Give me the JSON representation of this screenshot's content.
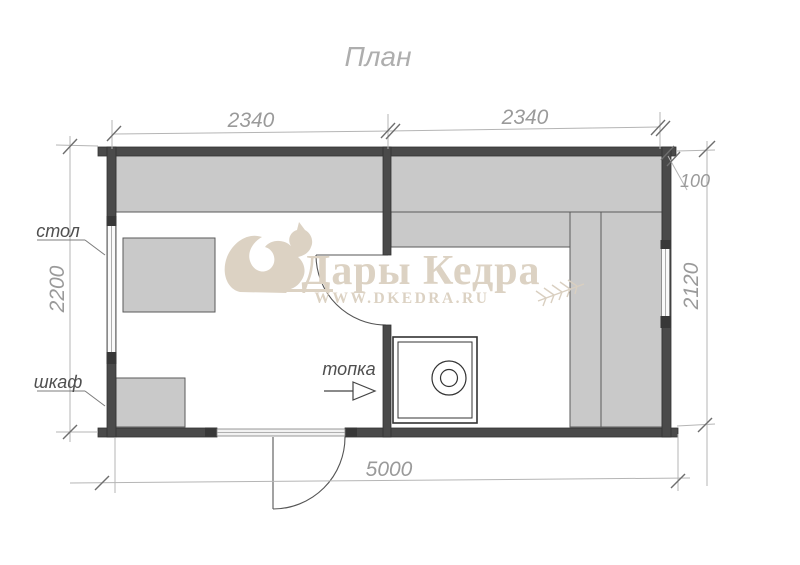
{
  "title": "План",
  "dimensions": {
    "top_left_room_width": "2340",
    "top_right_room_width": "2340",
    "wall_thickness": "100",
    "left_room_depth": "2200",
    "right_room_depth": "2120",
    "total_width": "5000"
  },
  "labels": {
    "table": "стол",
    "cabinet": "шкаф",
    "firebox": "топка"
  },
  "watermark": {
    "brand": "Дары Кедра",
    "site": "WWW.DKEDRA.RU",
    "icons": [
      "squirrel-icon",
      "wheat-sprig-icon"
    ],
    "color": "#dcd2c3"
  },
  "colors": {
    "wall": "#4a4a4a",
    "furniture_fill": "#c9c9c9",
    "dimension_line": "#b5b5b5",
    "tick": "#6e6e6e",
    "plan_line": "#555555"
  }
}
